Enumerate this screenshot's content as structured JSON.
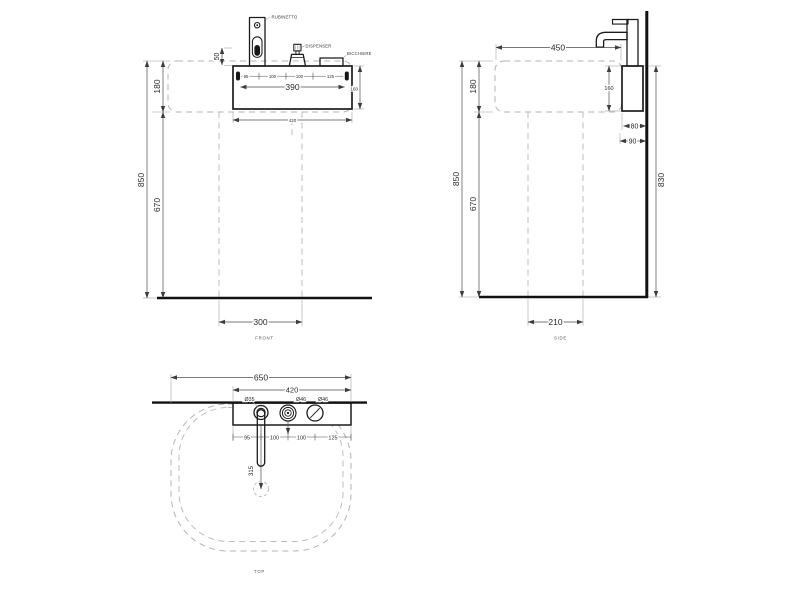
{
  "front": {
    "view_label": "FRONT",
    "callouts": {
      "faucet": "RUBINETTO",
      "dispenser": "DISPENSER",
      "glass": "BICCHIERE"
    },
    "dims": {
      "overall_height": "850",
      "top_height": "180",
      "bottom_height": "670",
      "shelf_lip": "50",
      "hole_span": "390",
      "box_width": "420",
      "box_height": "160",
      "pedestal_width": "300",
      "chain": [
        "95",
        "100",
        "100",
        "125"
      ]
    }
  },
  "side": {
    "view_label": "SIDE",
    "dims": {
      "depth": "450",
      "top_height": "180",
      "box_height": "160",
      "box_depth": "80",
      "wall_offset": "90",
      "overall_height": "850",
      "bottom_height": "670",
      "wall_height": "830",
      "pedestal_depth": "210"
    }
  },
  "top": {
    "view_label": "TOP",
    "dims": {
      "overall_width": "650",
      "shelf_width": "420",
      "hole_faucet": "Ø35",
      "hole_dispenser": "Ø46",
      "hole_glass": "Ø46",
      "spout_reach": "315",
      "chain": [
        "95",
        "100",
        "100",
        "125"
      ]
    }
  }
}
